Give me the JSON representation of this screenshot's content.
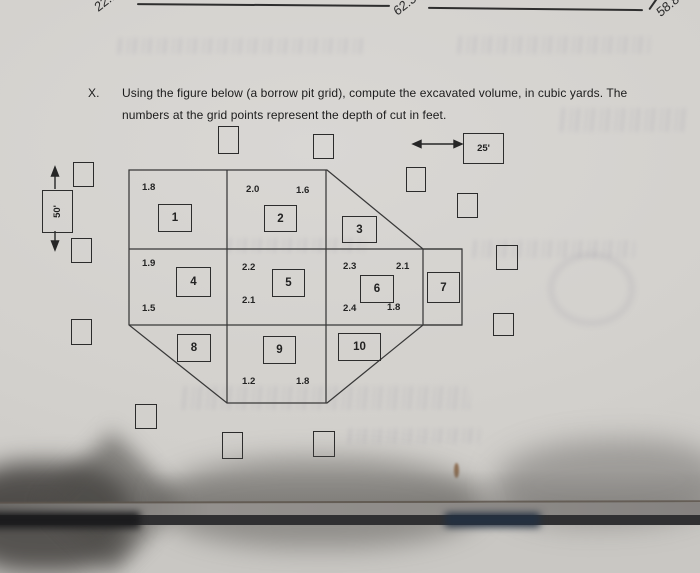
{
  "colors": {
    "paper": "#d3d1cd",
    "ink": "#2b2b2b"
  },
  "previous_problem": {
    "answers": [
      {
        "value": "22.1"
      },
      {
        "value": "62.3"
      },
      {
        "value": "58.8"
      }
    ]
  },
  "problem": {
    "number": "X.",
    "line1": "Using the figure below (a borrow pit grid), compute the excavated volume, in cubic yards. The",
    "line2": "numbers at the grid points represent the depth of cut in feet."
  },
  "figure": {
    "horizontal_scale": {
      "label": "25'"
    },
    "vertical_scale": {
      "label": "50'"
    },
    "cells": [
      {
        "label": "1"
      },
      {
        "label": "2"
      },
      {
        "label": "3"
      },
      {
        "label": "4"
      },
      {
        "label": "5"
      },
      {
        "label": "6"
      },
      {
        "label": "7"
      },
      {
        "label": "8"
      },
      {
        "label": "9"
      },
      {
        "label": "10"
      }
    ],
    "depths": [
      {
        "value": "1.8"
      },
      {
        "value": "2.0"
      },
      {
        "value": "1.6"
      },
      {
        "value": "1.9"
      },
      {
        "value": "1.5"
      },
      {
        "value": "2.2"
      },
      {
        "value": "2.1"
      },
      {
        "value": "2.3"
      },
      {
        "value": "2.1"
      },
      {
        "value": "2.4"
      },
      {
        "value": "1.8"
      },
      {
        "value": "1.2"
      },
      {
        "value": "1.8"
      }
    ]
  }
}
